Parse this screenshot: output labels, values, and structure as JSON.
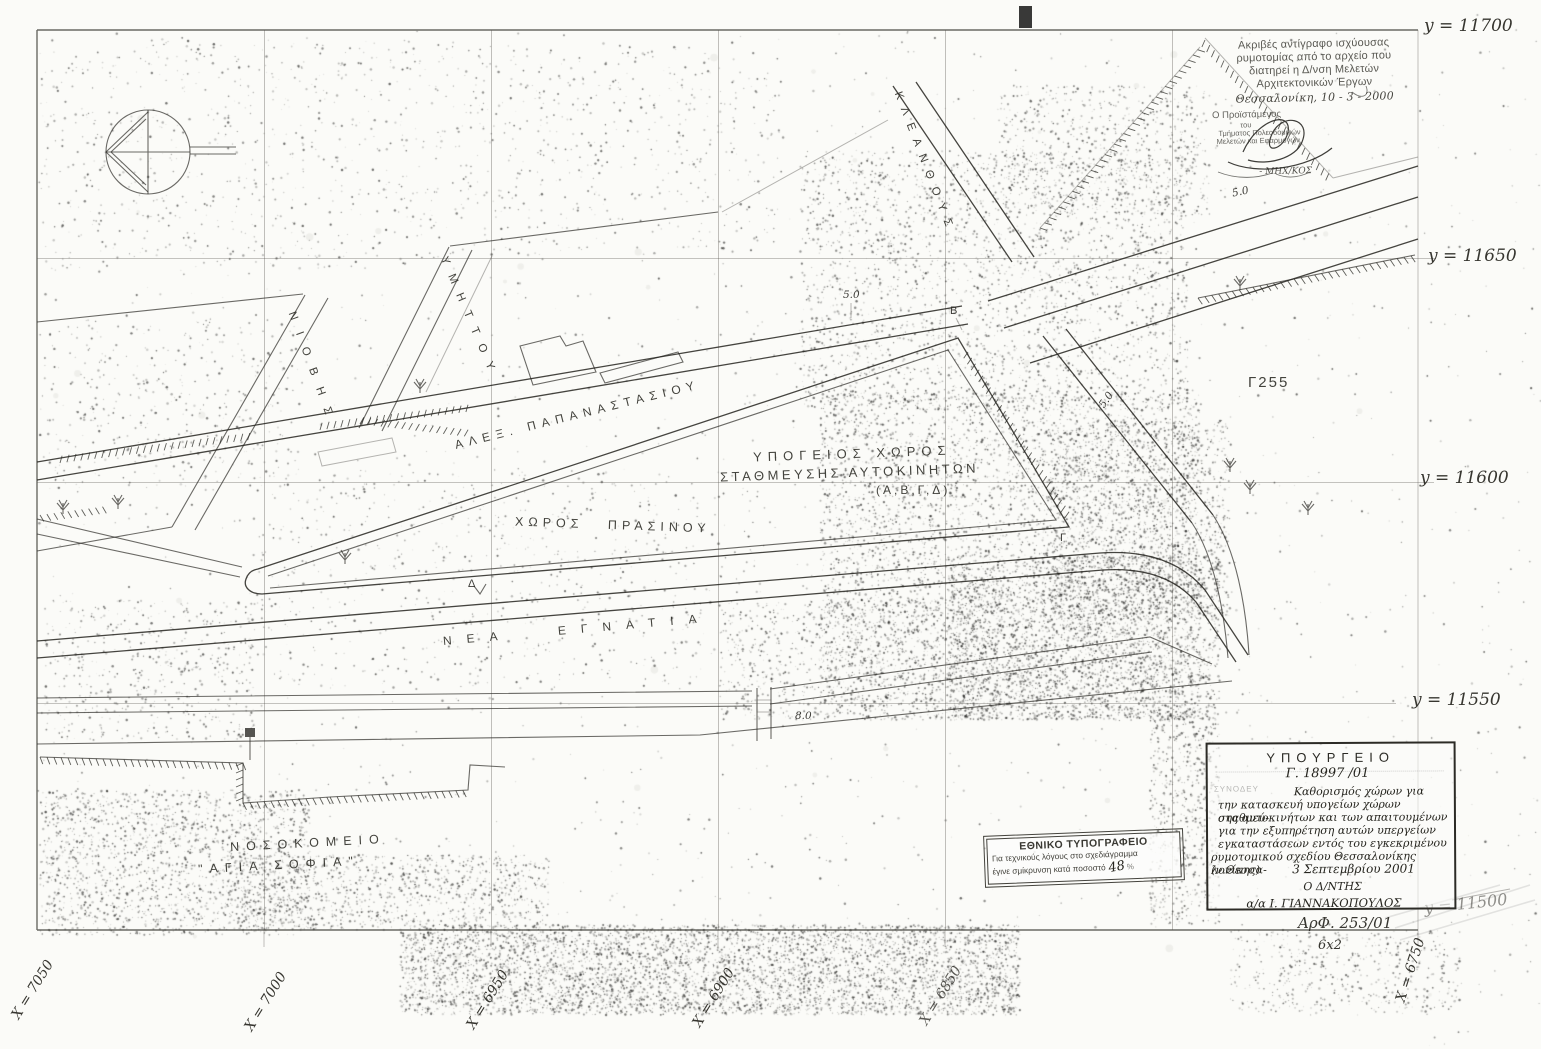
{
  "map": {
    "grid": {
      "y_labels": [
        "y = 11700",
        "y = 11650",
        "y = 11600",
        "y = 11550",
        "y = 11500"
      ],
      "x_labels": [
        "Χ = 7050",
        "Χ = 7000",
        "Χ = 6950",
        "Χ = 6900",
        "Χ = 6850",
        "Χ = 6750"
      ]
    },
    "streets": {
      "papanastasiou": "ΑΛΕΞ.  ΠΑΠΑΝΑΣΤΑΣΙΟΥ",
      "nea_egnatia": "ΝΕΑ  ΕΓΝΑΤΙΑ",
      "kleanthous": "ΚΛΕΑΝΘΟΥΣ",
      "ymittou": "ΥΜΗΤΤΟΥ",
      "niovis": "ΝΙΟΒΗΣ"
    },
    "labels": {
      "parking_line1": "ΥΠΟΓΕΙΟΣ  ΧΩΡΟΣ",
      "parking_line2": "ΣΤΑΘΜΕΥΣΗΣ  ΑΥΤΟΚΙΝΗΤΩΝ",
      "parking_line3": "(Α,Β,Γ,Δ)",
      "green_area": "ΧΩΡΟΣ  ΠΡΑΣΙΝΟΥ",
      "hospital_line1": "ΝΟΣΟΚΟΜΕΙΟ",
      "hospital_line2": "\"ΑΓΙΑ  ΣΟΦΙΑ\"",
      "block_id": "Γ255"
    },
    "points": {
      "b": "Β",
      "g": "Γ",
      "d": "Δ"
    },
    "dimensions": {
      "d1": "5.0",
      "d2": "5.0",
      "d3": "5.0",
      "d4": "8.0"
    }
  },
  "stamp_archive": {
    "line1": "Ακριβές αντίγραφο ισχύουσας",
    "line2": "ρυμοτομίας από το αρχείο που",
    "line3": "διατηρεί η Δ/νση Μελετών",
    "line4": "Αρχιτεκτονικών Έργων",
    "city_date": "Θεσσαλονίκη, 10 - 3 - 2000",
    "role_line1": "Ο Προϊστάμενος",
    "role_line2": "του",
    "role_line3": "Τμήματος Πολεοδομικών",
    "role_line4": "Μελετών και Εφαρμογών",
    "signer_title": "- ΜΗΧ/ΚΟΣ"
  },
  "stamp_ministry": {
    "title": "ΥΠΟΥΡΓΕΙΟ",
    "faint_left": "ΣΥΝΟΔΕΥ",
    "protocol": "Γ. 18997 /01",
    "body_line1": "Καθορισμός χώρων για",
    "body_line2": "την κατασκευή υπογείων χώρων σταθμεύ-",
    "body_line3": "σης αυτοκινήτων και των απαιτουμένων",
    "body_line4": "για την εξυπηρέτηση αυτών υπεργείων",
    "body_line5": "εγκαταστάσεων εντός του εγκεκριμένου",
    "body_line6": "ρυμοτομικού σχεδίου Θεσσαλονίκης (ν.Θεσσα-",
    "body_line7": "λονίκης)",
    "date": "3 Σεπτεμβρίου 2001",
    "director": "Ο Δ/ΝΤΗΣ",
    "signed_by": "α/α   Ι. ΓΙΑΝΝΑΚΟΠΟΥΛΟΣ",
    "ref_number": "ΑρΦ. 253/01",
    "scale_note": "6x2"
  },
  "stamp_printing": {
    "title": "ΕΘΝΙΚΟ ΤΥΠΟΓΡΑΦΕΙΟ",
    "line1": "Για τεχνικούς λόγους στο σχεδιάγραμμα",
    "line2": "έγινε σμίκρυνση κατά ποσοστό",
    "percent_value": "48",
    "percent_sign": "%"
  }
}
